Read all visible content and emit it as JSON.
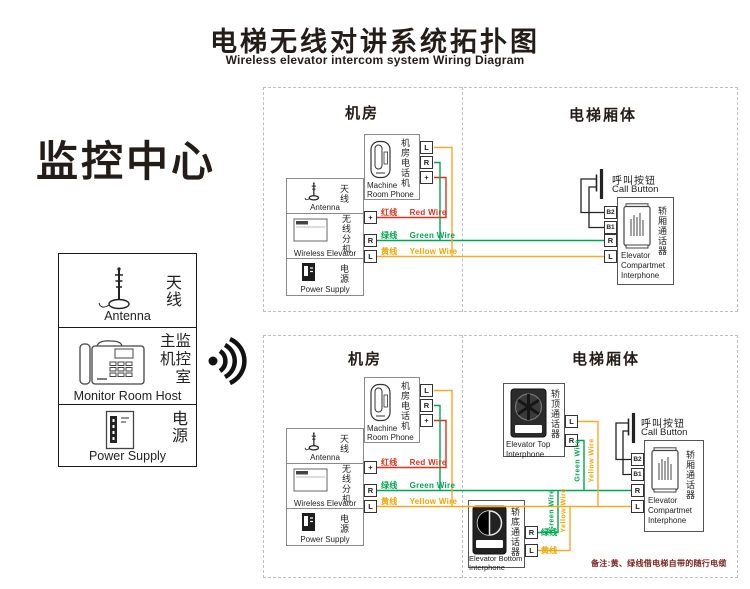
{
  "title": {
    "zh": "电梯无线对讲系统拓扑图",
    "en": "Wireless elevator intercom system Wiring Diagram"
  },
  "monitor": {
    "heading": "监控中心",
    "antenna_zh": "天线",
    "antenna_en": "Antenna",
    "host_l1": "主监",
    "host_l2": "机控",
    "host_l3": "室",
    "host_en": "Monitor Room Host",
    "power_zh": "电源",
    "power_en": "Power Supply"
  },
  "sections": {
    "machine_room": "机房",
    "elevator_body": "电梯厢体"
  },
  "dev": {
    "phone_zh": "机房电话机",
    "phone_en1": "Machine",
    "phone_en2": "Room Phone",
    "unit_ant_zh": "天线",
    "unit_ant_en": "Antenna",
    "unit_ext_zh": "无线分机",
    "unit_ext_en": "Wireless Elevator",
    "unit_pwr_zh": "电源",
    "unit_pwr_en": "Power Supply",
    "call_zh": "呼叫按钮",
    "call_en": "Call Button",
    "comp_zh": "轿厢通话器",
    "comp_en1": "Elevator",
    "comp_en2": "Compartmet",
    "comp_en3": "Interphone",
    "top_zh": "轿顶通话器",
    "top_en1": "Elevator Top",
    "top_en2": "Interphone",
    "bot_zh": "轿底通话器",
    "bot_en1": "Elevator Bottom",
    "bot_en2": "Interphone"
  },
  "term": {
    "plus": "+",
    "r": "R",
    "l": "L",
    "b1": "B1",
    "b2": "B2"
  },
  "wire": {
    "red_zh": "红线",
    "red_en": "Red Wire",
    "green_zh": "绿线",
    "green_en": "Green Wire",
    "yellow_zh": "黄线",
    "yellow_en": "Yellow Wire"
  },
  "note": {
    "text": "备注:黄、绿线借电梯自带的随行电缆"
  },
  "colors": {
    "red": "#e0301e",
    "green": "#00a551",
    "yellow": "#f5a928",
    "black": "#222222",
    "note": "#7b241c"
  }
}
